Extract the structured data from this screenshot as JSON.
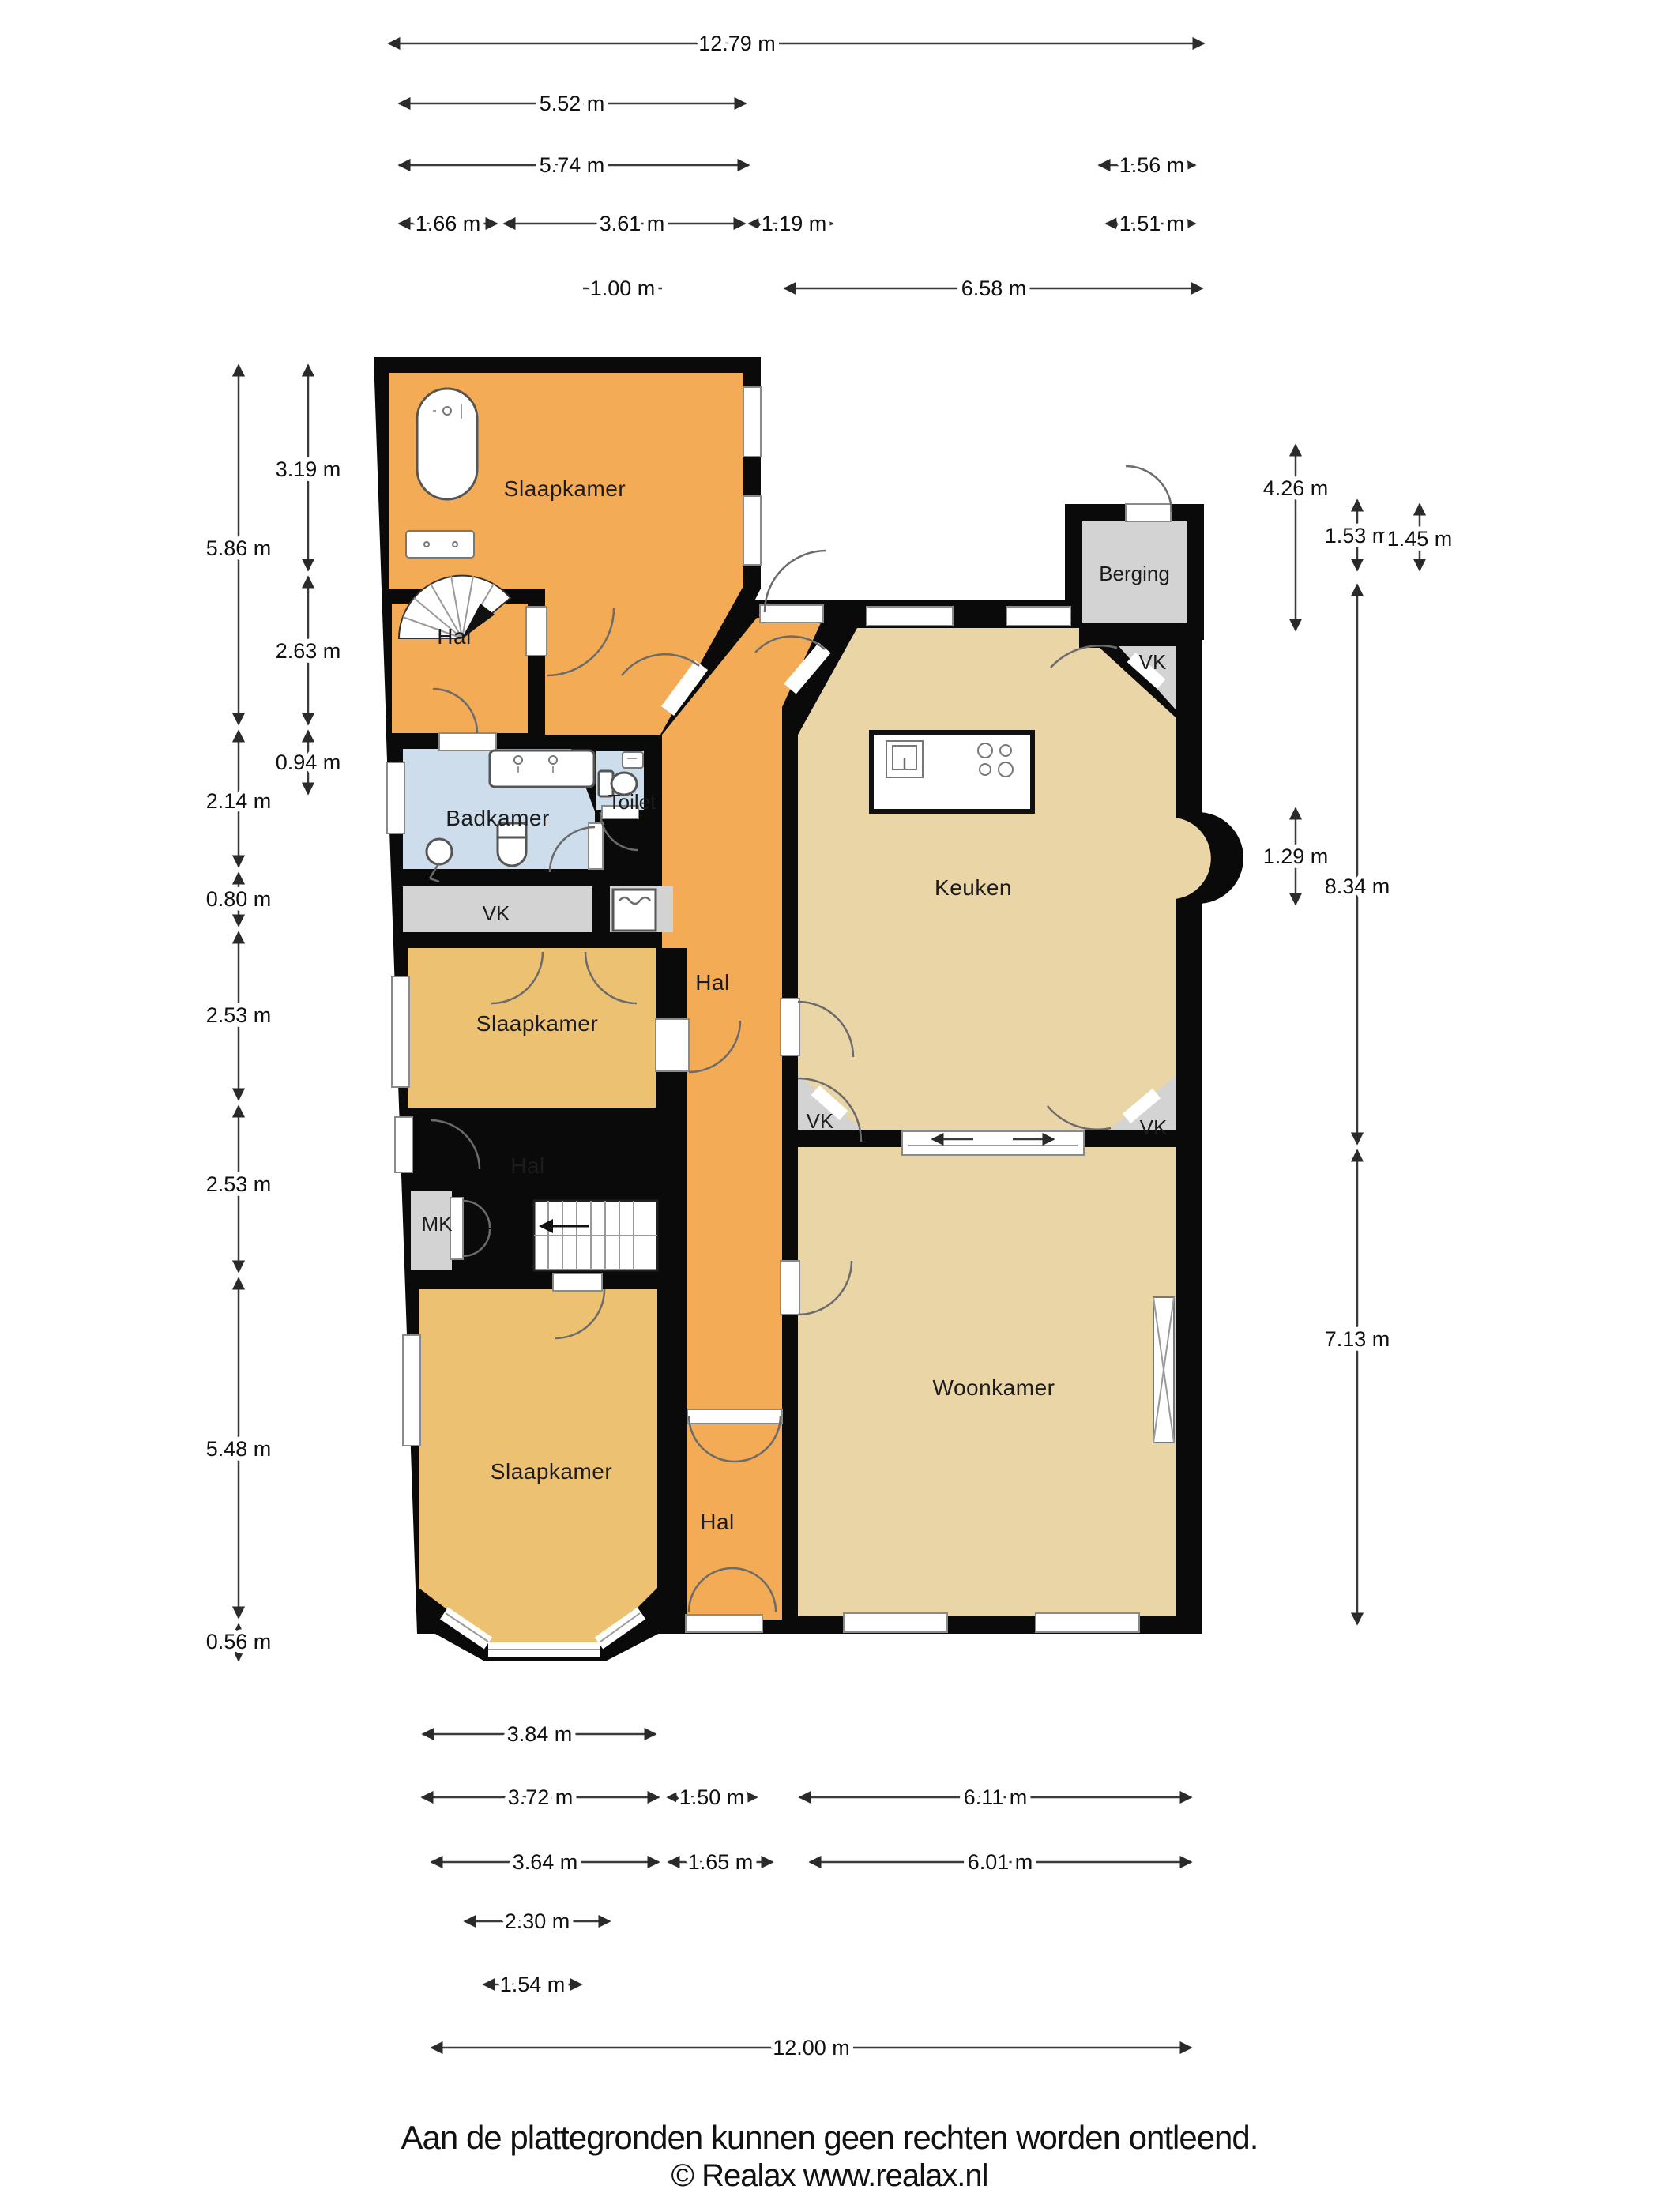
{
  "footer": {
    "line1": "Aan de plattegronden kunnen geen rechten worden ontleend.",
    "line2": "© Realax www.realax.nl"
  },
  "colors": {
    "wall": "#0a0a0a",
    "room_orange": "#F3AC55",
    "room_tan": "#ECC272",
    "room_beige": "#EAD5A6",
    "room_blue": "#CDDDEC",
    "room_grey": "#D3D3D3"
  },
  "rooms": {
    "slaapkamer_top": "Slaapkamer",
    "hal_top": "Hal",
    "berging": "Berging",
    "vk_top_right": "VK",
    "badkamer": "Badkamer",
    "toilet": "Toilet",
    "keuken": "Keuken",
    "vk_left": "VK",
    "hal_center": "Hal",
    "slaapkamer_mid": "Slaapkamer",
    "vk_bottom_left": "VK",
    "vk_bottom_right": "VK",
    "hal_mid": "Hal",
    "mk": "MK",
    "slaapkamer_bottom": "Slaapkamer",
    "woonkamer": "Woonkamer",
    "hal_bottom": "Hal"
  },
  "dims": {
    "top": [
      "12.79 m",
      "5.52 m",
      "5.74 m",
      "1.56 m",
      "1.66 m",
      "3.61 m",
      "1.19 m",
      "1.51 m",
      "1.00 m",
      "6.58 m"
    ],
    "left": [
      "5.86 m",
      "2.14 m",
      "0.80 m",
      "2.53 m",
      "2.53 m",
      "5.48 m",
      "0.56 m",
      "3.19 m",
      "2.63 m",
      "0.94 m"
    ],
    "right": [
      "4.26 m",
      "1.53 m",
      "1.45 m",
      "1.29 m",
      "8.34 m",
      "7.13 m"
    ],
    "bottom": [
      "3.84 m",
      "3.72 m",
      "1.50 m",
      "6.11 m",
      "3.64 m",
      "1.65 m",
      "6.01 m",
      "2.30 m",
      "1.54 m",
      "12.00 m"
    ]
  }
}
